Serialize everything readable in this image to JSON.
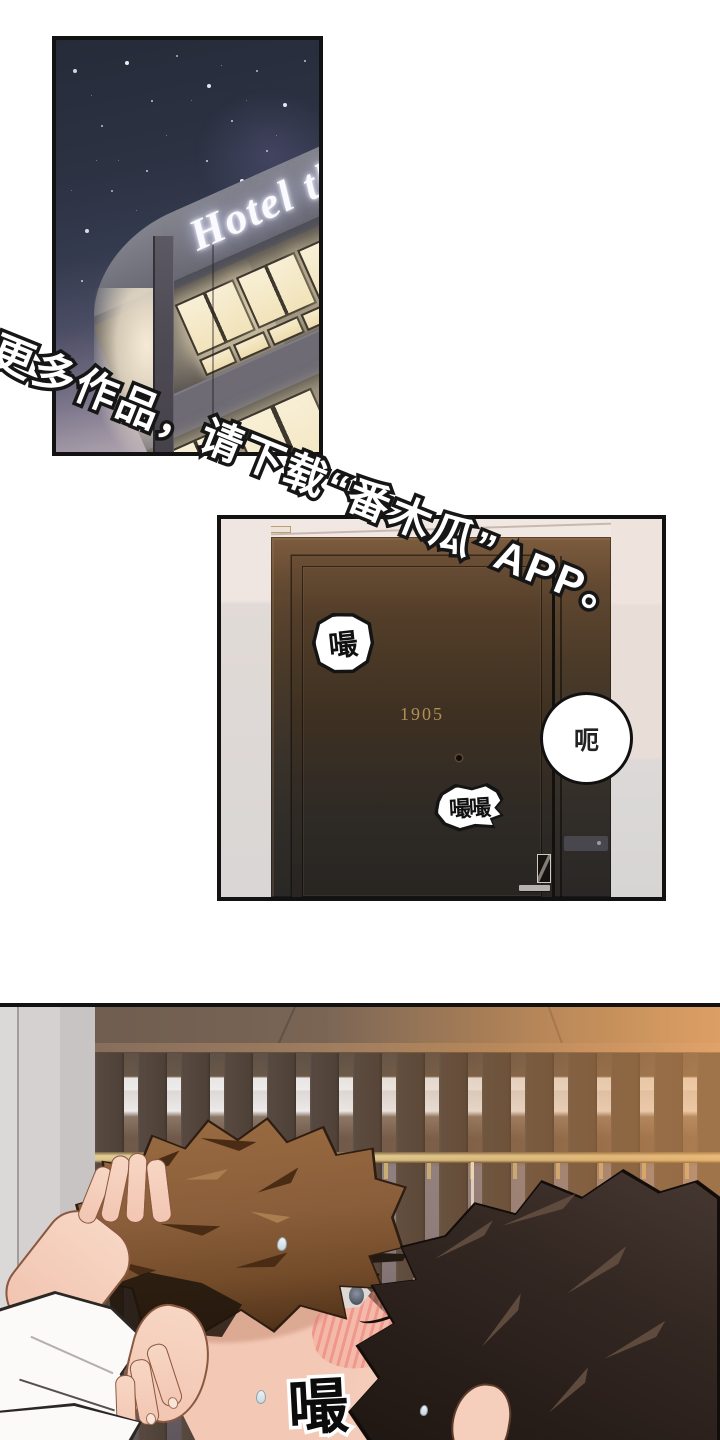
{
  "watermark": {
    "text": "更多作品，请下载“番木瓜”APP。"
  },
  "hotel_panel": {
    "sign_text": "Hotel th"
  },
  "door_panel": {
    "room_number": "1905",
    "sfx_kiss_small": "嘬",
    "sfx_kiss_double": "嘬嘬",
    "speech_grunt": "呃"
  },
  "kiss_panel": {
    "sfx_kiss_large": "嘬"
  },
  "colors": {
    "panel_border": "#121212",
    "night_sky": "#2c3242",
    "lit_window": "#f7ecd0",
    "door_wood_top": "#7d5c3e",
    "door_wood_bottom": "#2a2826",
    "room_number_text": "#b28f58",
    "warm_light": "#cf9a6b",
    "watermark_fill": "#ffffff",
    "watermark_outline": "#161616"
  }
}
